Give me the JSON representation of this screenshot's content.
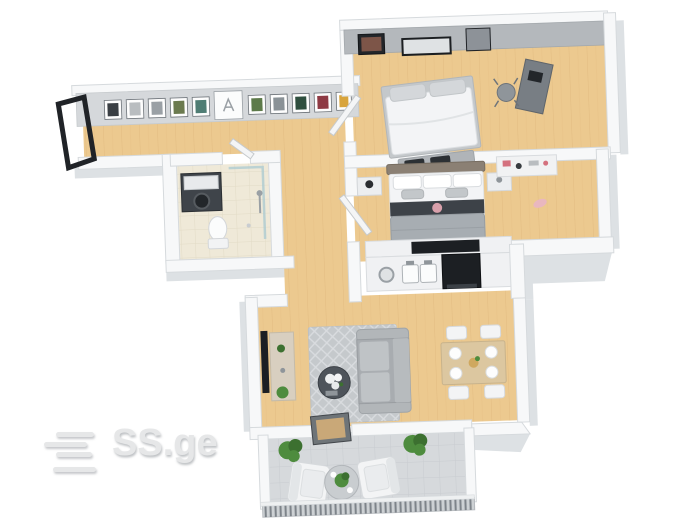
{
  "image": {
    "kind": "3d-floor-plan-render",
    "view": "top-down isometric apartment plan on white background"
  },
  "watermark": {
    "brand": "SS.ge",
    "logo": "four-offset-bars"
  },
  "rooms": [
    {
      "id": "hallway",
      "label": "entrance hallway",
      "furniture": [
        "entrance-door",
        "gallery-wall-11-frames"
      ]
    },
    {
      "id": "bathroom",
      "label": "bathroom",
      "furniture": [
        "washing-machine",
        "toilet",
        "shower"
      ]
    },
    {
      "id": "bedroom-1",
      "label": "bedroom (top)",
      "furniture": [
        "double-bed",
        "foot-bench",
        "desk",
        "desk-chair",
        "wall-art-3-frames"
      ]
    },
    {
      "id": "bedroom-2",
      "label": "bedroom (middle)",
      "furniture": [
        "double-bed",
        "nightstand-left",
        "nightstand-right",
        "dresser",
        "tv"
      ]
    },
    {
      "id": "kitchen",
      "label": "kitchen",
      "furniture": [
        "counter",
        "round-sink",
        "double-sink",
        "stove"
      ]
    },
    {
      "id": "living-room",
      "label": "living / dining room",
      "furniture": [
        "wall-tv",
        "tv-console",
        "rug",
        "sofa",
        "coffee-table",
        "dining-table",
        "dining-chairs-4"
      ]
    },
    {
      "id": "balcony",
      "label": "balcony",
      "furniture": [
        "glass-door",
        "armchair-left",
        "armchair-right",
        "round-table",
        "potted-plant-left",
        "potted-plant-right",
        "railing"
      ]
    }
  ],
  "colors": {
    "background": "#ffffff",
    "wall_top": "#f7f8f9",
    "wall_face": "#dde1e4",
    "wall_dark": "#b4b8bc",
    "wood_floor": "#ecc98f",
    "wood_line": "#dfb77b",
    "bathroom_floor": "#efe9d8",
    "tile_line": "#e2dbc6",
    "balcony_floor": "#d6d9dc",
    "balcony_tile_line": "#c8ccd0",
    "dark_appliance": "#1c1f23",
    "sofa": "#a8acb0",
    "rug": "#c5c9cc",
    "plant_green": "#4e8c3e",
    "plant_dark": "#3c7030",
    "bed_blanket": "#a7adb2",
    "bed_white": "#f3f4f6",
    "counter_white": "#f0f1f3",
    "dining_table": "#dcc7a0",
    "console_beige": "#d8cfc0",
    "headboard_taupe": "#8b8074",
    "watermark": "#e6e7e8"
  }
}
